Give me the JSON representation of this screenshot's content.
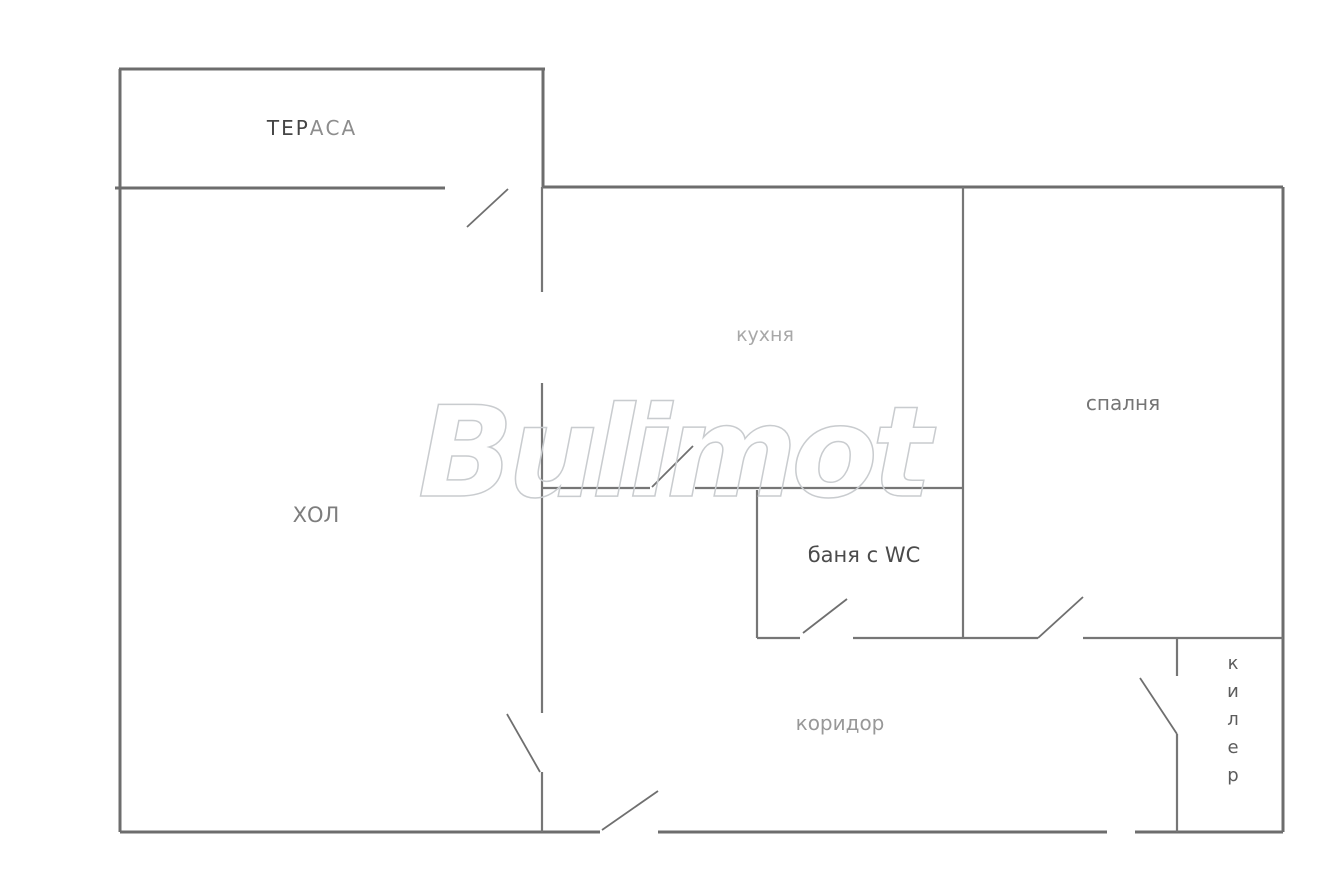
{
  "document": {
    "type": "apartment-floor-plan",
    "background_color": "#ffffff",
    "wall_color": "#767676",
    "outer_wall_color": "#6d6d6d",
    "door_color": "#6f6f6f",
    "canvas": {
      "width": 1344,
      "height": 892
    }
  },
  "floorplan": {
    "walls_outer": [
      [
        119,
        69,
        545,
        69
      ],
      [
        120,
        69,
        120,
        188
      ],
      [
        543,
        69,
        543,
        188
      ],
      [
        115,
        188,
        445,
        188
      ],
      [
        120,
        188,
        120,
        832
      ],
      [
        543,
        187,
        1283,
        187
      ],
      [
        1283,
        187,
        1283,
        832
      ],
      [
        120,
        832,
        600,
        832
      ],
      [
        658,
        832,
        1107,
        832
      ],
      [
        1135,
        832,
        1283,
        832
      ]
    ],
    "walls_inner": [
      [
        542,
        187,
        542,
        292
      ],
      [
        542,
        383,
        542,
        713
      ],
      [
        542,
        772,
        542,
        832
      ],
      [
        542,
        488,
        650,
        488
      ],
      [
        695,
        488,
        963,
        488
      ],
      [
        757,
        490,
        757,
        638
      ],
      [
        757,
        638,
        800,
        638
      ],
      [
        853,
        638,
        963,
        638
      ],
      [
        963,
        187,
        963,
        638
      ],
      [
        963,
        638,
        1038,
        638
      ],
      [
        1083,
        638,
        1283,
        638
      ],
      [
        1177,
        638,
        1177,
        676
      ],
      [
        1177,
        734,
        1177,
        832
      ]
    ],
    "door_swings": [
      {
        "name": "terrace-door",
        "line": [
          467,
          227,
          508,
          189
        ]
      },
      {
        "name": "kitchen-door",
        "line": [
          652,
          487,
          693,
          446
        ]
      },
      {
        "name": "hall-door",
        "line": [
          507,
          714,
          540,
          772
        ]
      },
      {
        "name": "entrance-door",
        "line": [
          602,
          830,
          658,
          791
        ]
      },
      {
        "name": "bathroom-door",
        "line": [
          803,
          633,
          847,
          599
        ]
      },
      {
        "name": "bedroom-door",
        "line": [
          1038,
          638,
          1083,
          597
        ]
      },
      {
        "name": "pantry-door",
        "line": [
          1140,
          678,
          1177,
          734
        ]
      }
    ],
    "labels": [
      {
        "name": "terrace-label",
        "x": 312,
        "y": 135,
        "size": 20,
        "spacing": 2,
        "parts": [
          {
            "text": "ТЕР",
            "color": "#454545"
          },
          {
            "text": "АСА",
            "color": "#8d8d8d"
          }
        ]
      },
      {
        "name": "kitchen-label",
        "text": "кухня",
        "x": 765,
        "y": 341,
        "size": 19,
        "color": "#a8a8a8"
      },
      {
        "name": "bedroom-label",
        "text": "спалня",
        "x": 1123,
        "y": 410,
        "size": 20,
        "color": "#757575"
      },
      {
        "name": "hall-label",
        "text": "ХОЛ",
        "x": 316,
        "y": 522,
        "size": 21,
        "color": "#7d7d7d"
      },
      {
        "name": "bathroom-label",
        "text": "баня с WC",
        "x": 864,
        "y": 562,
        "size": 21,
        "color": "#4b4b4b"
      },
      {
        "name": "corridor-label",
        "text": "коридор",
        "x": 840,
        "y": 730,
        "size": 20,
        "color": "#989898"
      },
      {
        "name": "pantry-label",
        "text": "килер",
        "x": 1233,
        "y": 669,
        "size": 18,
        "color": "#5c5c5c",
        "vertical": true,
        "letter_step": 28
      }
    ],
    "watermark": {
      "text": "Bulimot",
      "x": 672,
      "y": 496,
      "size": 126,
      "letter_spacing": -6,
      "stroke_color": "#c9cccf",
      "stroke_width": 1.5
    }
  }
}
